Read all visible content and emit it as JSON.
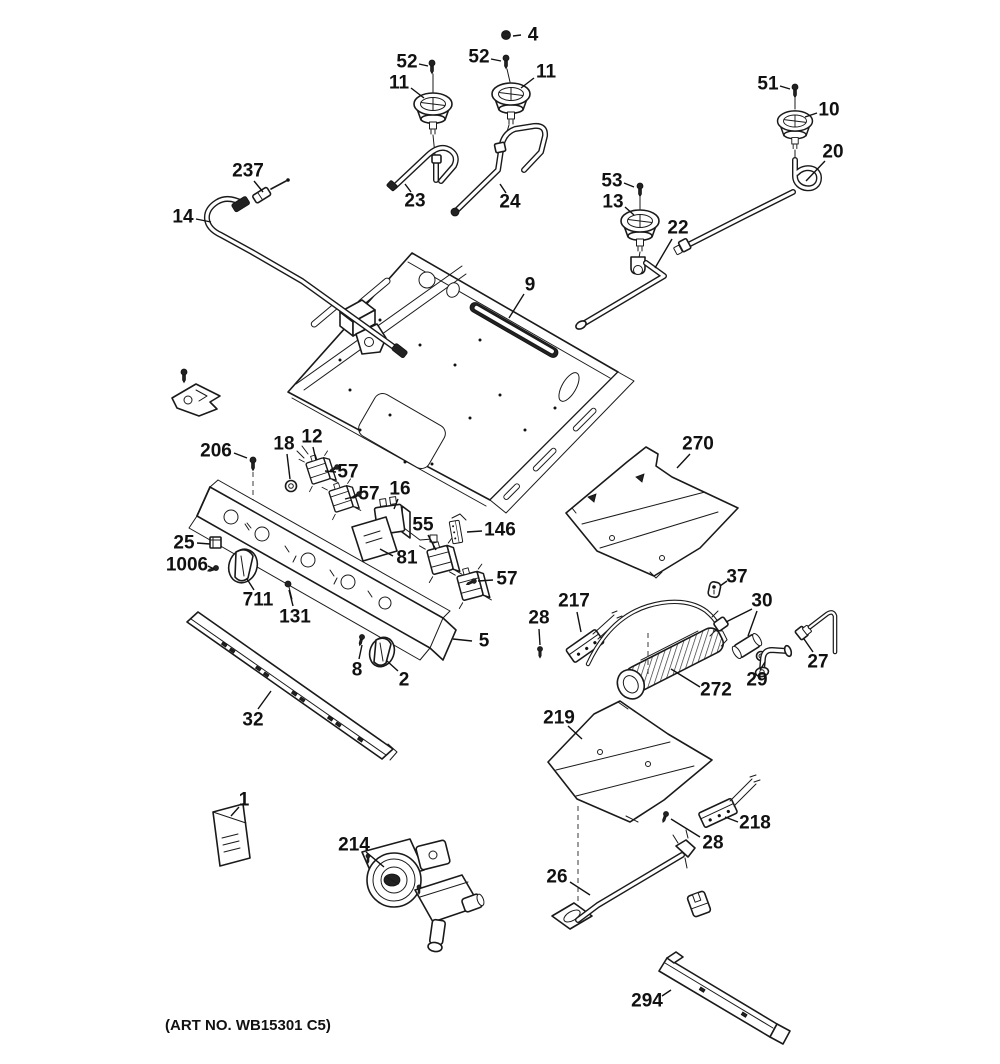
{
  "art_no": "(ART NO. WB15301 C5)",
  "diagram_title": "Gas range burner parts exploded diagram",
  "callouts": [
    {
      "id": "4",
      "text": "4",
      "x": 533,
      "y": 35,
      "leaders": [
        [
          521,
          35,
          513,
          36
        ]
      ]
    },
    {
      "id": "52a",
      "text": "52",
      "x": 407,
      "y": 62,
      "leaders": [
        [
          419,
          64,
          428,
          66
        ]
      ]
    },
    {
      "id": "11a",
      "text": "11",
      "x": 399,
      "y": 83,
      "leaders": [
        [
          411,
          88,
          424,
          98
        ]
      ]
    },
    {
      "id": "52b",
      "text": "52",
      "x": 479,
      "y": 57,
      "leaders": [
        [
          491,
          59,
          501,
          61
        ]
      ]
    },
    {
      "id": "11b",
      "text": "11",
      "x": 546,
      "y": 72,
      "leaders": [
        [
          534,
          78,
          521,
          88
        ]
      ]
    },
    {
      "id": "51",
      "text": "51",
      "x": 768,
      "y": 84,
      "leaders": [
        [
          780,
          86,
          790,
          89
        ]
      ]
    },
    {
      "id": "10",
      "text": "10",
      "x": 829,
      "y": 110,
      "leaders": [
        [
          817,
          113,
          805,
          117
        ]
      ]
    },
    {
      "id": "20",
      "text": "20",
      "x": 833,
      "y": 152,
      "leaders": [
        [
          825,
          161,
          806,
          181
        ]
      ]
    },
    {
      "id": "237",
      "text": "237",
      "x": 248,
      "y": 171,
      "leaders": [
        [
          254,
          181,
          263,
          192
        ]
      ]
    },
    {
      "id": "14",
      "text": "14",
      "x": 183,
      "y": 217,
      "leaders": [
        [
          196,
          219,
          211,
          222
        ]
      ]
    },
    {
      "id": "23",
      "text": "23",
      "x": 415,
      "y": 201,
      "leaders": [
        [
          411,
          192,
          405,
          184
        ]
      ]
    },
    {
      "id": "24",
      "text": "24",
      "x": 510,
      "y": 202,
      "leaders": [
        [
          506,
          193,
          500,
          184
        ]
      ]
    },
    {
      "id": "53",
      "text": "53",
      "x": 612,
      "y": 181,
      "leaders": [
        [
          624,
          183,
          634,
          187
        ]
      ]
    },
    {
      "id": "13",
      "text": "13",
      "x": 613,
      "y": 202,
      "leaders": [
        [
          625,
          207,
          634,
          215
        ]
      ]
    },
    {
      "id": "22",
      "text": "22",
      "x": 678,
      "y": 228,
      "leaders": [
        [
          672,
          239,
          655,
          268
        ]
      ]
    },
    {
      "id": "9",
      "text": "9",
      "x": 530,
      "y": 285,
      "leaders": [
        [
          524,
          294,
          509,
          318
        ]
      ]
    },
    {
      "id": "206",
      "text": "206",
      "x": 216,
      "y": 451,
      "leaders": [
        [
          234,
          453,
          247,
          458
        ]
      ]
    },
    {
      "id": "18",
      "text": "18",
      "x": 284,
      "y": 444,
      "leaders": [
        [
          287,
          454,
          290,
          479
        ]
      ]
    },
    {
      "id": "12",
      "text": "12",
      "x": 312,
      "y": 437,
      "leaders": [
        [
          313,
          447,
          316,
          460
        ]
      ]
    },
    {
      "id": "57a",
      "text": "57",
      "x": 348,
      "y": 472,
      "leaders": [
        [
          336,
          472,
          325,
          471
        ]
      ]
    },
    {
      "id": "57b",
      "text": "57",
      "x": 369,
      "y": 494,
      "leaders": [
        [
          357,
          496,
          345,
          499
        ]
      ]
    },
    {
      "id": "16",
      "text": "16",
      "x": 400,
      "y": 489,
      "leaders": [
        [
          398,
          499,
          394,
          509
        ]
      ]
    },
    {
      "id": "55",
      "text": "55",
      "x": 423,
      "y": 525,
      "leaders": [
        [
          428,
          535,
          436,
          550
        ]
      ]
    },
    {
      "id": "146",
      "text": "146",
      "x": 500,
      "y": 530,
      "leaders": [
        [
          482,
          531,
          467,
          532
        ]
      ]
    },
    {
      "id": "81",
      "text": "81",
      "x": 407,
      "y": 558,
      "leaders": [
        [
          393,
          556,
          380,
          549
        ]
      ]
    },
    {
      "id": "57c",
      "text": "57",
      "x": 507,
      "y": 579,
      "leaders": [
        [
          493,
          580,
          478,
          581
        ]
      ]
    },
    {
      "id": "25",
      "text": "25",
      "x": 184,
      "y": 543,
      "leaders": [
        [
          197,
          543,
          210,
          544
        ]
      ]
    },
    {
      "id": "1006",
      "text": "1006",
      "x": 187,
      "y": 565,
      "leaders": [
        [
          208,
          566,
          214,
          569
        ]
      ]
    },
    {
      "id": "711",
      "text": "711",
      "x": 258,
      "y": 600,
      "leaders": [
        [
          254,
          590,
          247,
          579
        ]
      ]
    },
    {
      "id": "131",
      "text": "131",
      "x": 295,
      "y": 617,
      "leaders": [
        [
          293,
          606,
          289,
          590
        ]
      ]
    },
    {
      "id": "5",
      "text": "5",
      "x": 484,
      "y": 641,
      "leaders": [
        [
          472,
          641,
          453,
          639
        ]
      ]
    },
    {
      "id": "8",
      "text": "8",
      "x": 357,
      "y": 670,
      "leaders": [
        [
          359,
          659,
          362,
          645
        ]
      ]
    },
    {
      "id": "2",
      "text": "2",
      "x": 404,
      "y": 680,
      "leaders": [
        [
          398,
          671,
          387,
          661
        ]
      ]
    },
    {
      "id": "32",
      "text": "32",
      "x": 253,
      "y": 720,
      "leaders": [
        [
          258,
          709,
          271,
          691
        ]
      ]
    },
    {
      "id": "270",
      "text": "270",
      "x": 698,
      "y": 444,
      "leaders": [
        [
          690,
          454,
          677,
          468
        ]
      ]
    },
    {
      "id": "37",
      "text": "37",
      "x": 737,
      "y": 577,
      "leaders": [
        [
          727,
          581,
          720,
          586
        ]
      ]
    },
    {
      "id": "28a",
      "text": "28",
      "x": 539,
      "y": 618,
      "leaders": [
        [
          539,
          629,
          540,
          645
        ]
      ]
    },
    {
      "id": "217",
      "text": "217",
      "x": 574,
      "y": 601,
      "leaders": [
        [
          577,
          612,
          581,
          632
        ]
      ]
    },
    {
      "id": "30",
      "text": "30",
      "x": 762,
      "y": 601,
      "leaders": [
        [
          752,
          609,
          726,
          622
        ],
        [
          757,
          611,
          748,
          636
        ]
      ]
    },
    {
      "id": "272",
      "text": "272",
      "x": 716,
      "y": 690,
      "leaders": [
        [
          700,
          687,
          671,
          669
        ]
      ]
    },
    {
      "id": "27",
      "text": "27",
      "x": 818,
      "y": 662,
      "leaders": [
        [
          813,
          652,
          804,
          639
        ]
      ]
    },
    {
      "id": "29",
      "text": "29",
      "x": 757,
      "y": 680,
      "leaders": [
        [
          760,
          670,
          765,
          662
        ]
      ]
    },
    {
      "id": "219",
      "text": "219",
      "x": 559,
      "y": 718,
      "leaders": [
        [
          568,
          726,
          582,
          739
        ]
      ]
    },
    {
      "id": "218",
      "text": "218",
      "x": 755,
      "y": 823,
      "leaders": [
        [
          738,
          822,
          725,
          817
        ]
      ]
    },
    {
      "id": "28b",
      "text": "28",
      "x": 713,
      "y": 843,
      "leaders": [
        [
          700,
          837,
          671,
          819
        ]
      ]
    },
    {
      "id": "26",
      "text": "26",
      "x": 557,
      "y": 877,
      "leaders": [
        [
          570,
          882,
          590,
          895
        ]
      ]
    },
    {
      "id": "294",
      "text": "294",
      "x": 647,
      "y": 1001,
      "leaders": [
        [
          662,
          996,
          671,
          990
        ]
      ]
    },
    {
      "id": "1",
      "text": "1",
      "x": 244,
      "y": 800,
      "leaders": [
        [
          239,
          807,
          231,
          816
        ]
      ]
    },
    {
      "id": "214",
      "text": "214",
      "x": 354,
      "y": 845,
      "leaders": [
        [
          366,
          852,
          384,
          867
        ]
      ]
    }
  ]
}
